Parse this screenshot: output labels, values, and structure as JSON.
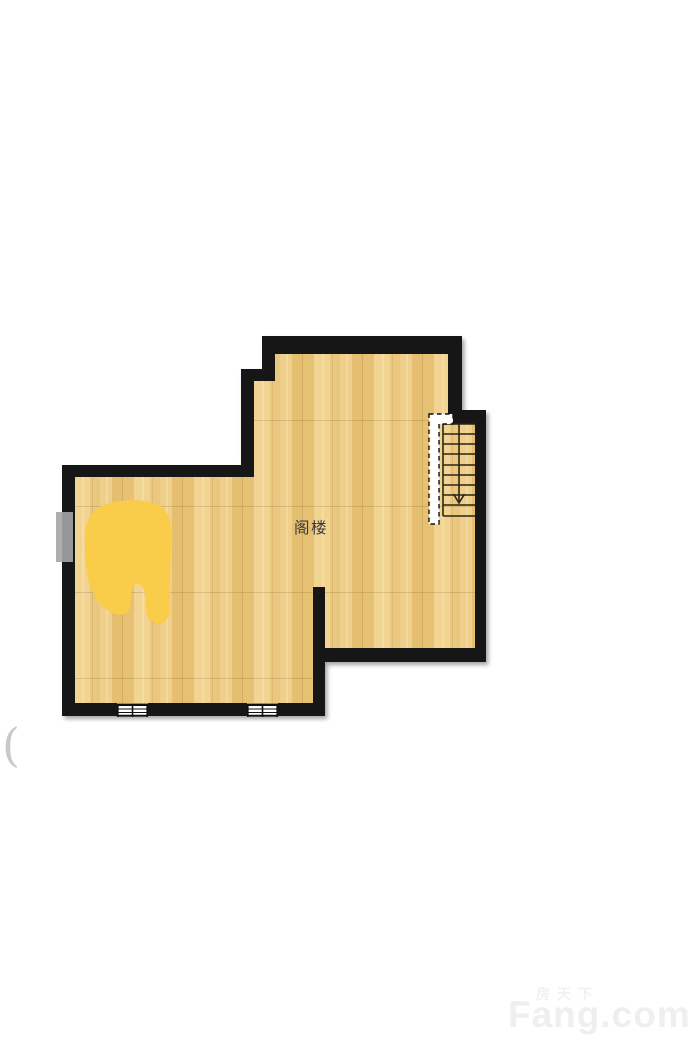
{
  "page": {
    "width": 693,
    "height": 1055,
    "background": "#ffffff"
  },
  "floor_plan": {
    "room_label": "阁楼",
    "room_label_color": "#3a3a3a",
    "wall_color": "#151515",
    "floor_base_color": "#ecc983",
    "floor_plank_colors": [
      "#e7c173",
      "#f1d392",
      "#e9c77e",
      "#efcf8b",
      "#e5bf70"
    ],
    "highlight_color": "#f9cc4a",
    "skylight_color": "#a5a5a5",
    "stairs": {
      "direction": "down",
      "tread_count": 10,
      "has_dashed_opening_line": true
    },
    "windows_bottom_wall_count": 2,
    "windows_left_wall_count": 1
  },
  "decor": {
    "left_edge_mark": "("
  },
  "watermark": {
    "cn": "房天下",
    "en": "Fang.com",
    "color": "#efefef"
  }
}
